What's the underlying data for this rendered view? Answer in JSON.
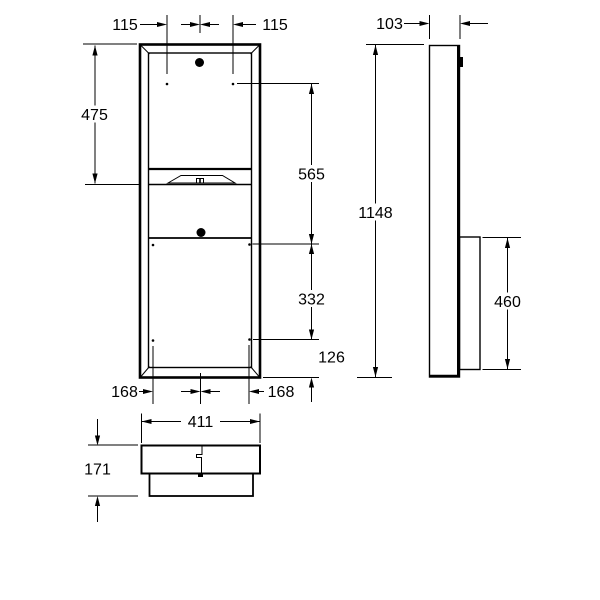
{
  "colors": {
    "ink": "#000000",
    "paper": "#ffffff"
  },
  "front_view": {
    "dim_hole_spacing_top_left": "115",
    "dim_hole_spacing_top_right": "115",
    "dim_top_to_towel_outlet": "475",
    "dim_holes_top_to_middle": "565",
    "dim_holes_middle_to_bottom": "332",
    "dim_holes_bottom_to_edge": "126",
    "dim_hole_spacing_bottom_left": "168",
    "dim_hole_spacing_bottom_right": "168"
  },
  "side_view": {
    "dim_depth": "103",
    "dim_total_height": "1148",
    "dim_recess_box_height": "460"
  },
  "bottom_view": {
    "dim_width": "411",
    "dim_total_depth": "171"
  }
}
